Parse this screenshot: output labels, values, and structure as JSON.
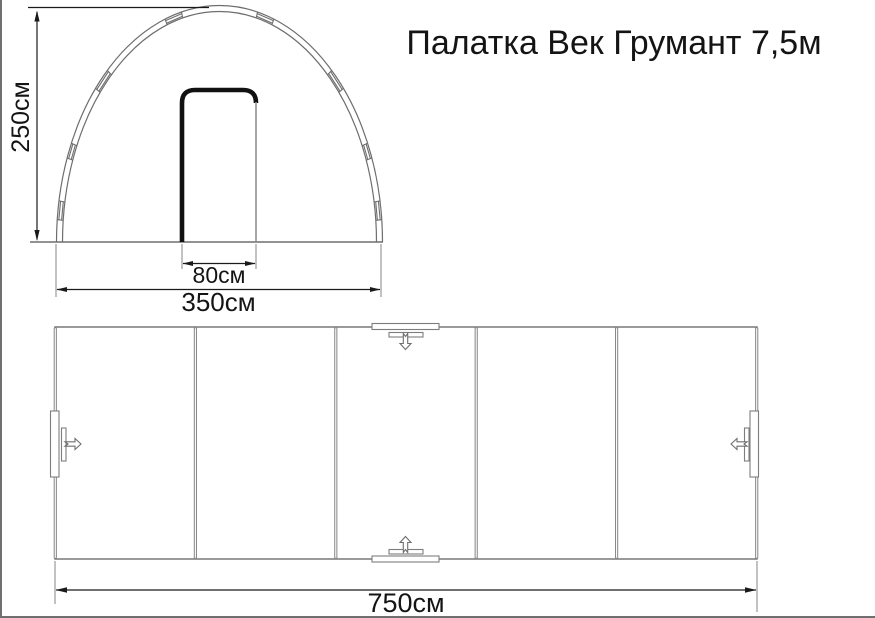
{
  "title": "Палатка Век Грумант 7,5м",
  "front_view": {
    "height_dim": "250см",
    "width_dim": "350см",
    "door_width_dim": "80см"
  },
  "top_view": {
    "length_dim": "750см",
    "panel_count": 5
  },
  "icons": {
    "top_vent_arrow": "arrow-down-outline",
    "bottom_vent_arrow": "arrow-up-outline",
    "left_door_arrow": "arrow-right-outline",
    "right_door_arrow": "arrow-left-outline"
  },
  "colors": {
    "background": "#ffffff",
    "drawing_line": "#6e6e6e",
    "wall_line": "#8a8a8a",
    "dimension_line": "#1a1a1a",
    "door_stroke": "#111111",
    "page_border": "#6f6f6f",
    "text": "#141414"
  }
}
